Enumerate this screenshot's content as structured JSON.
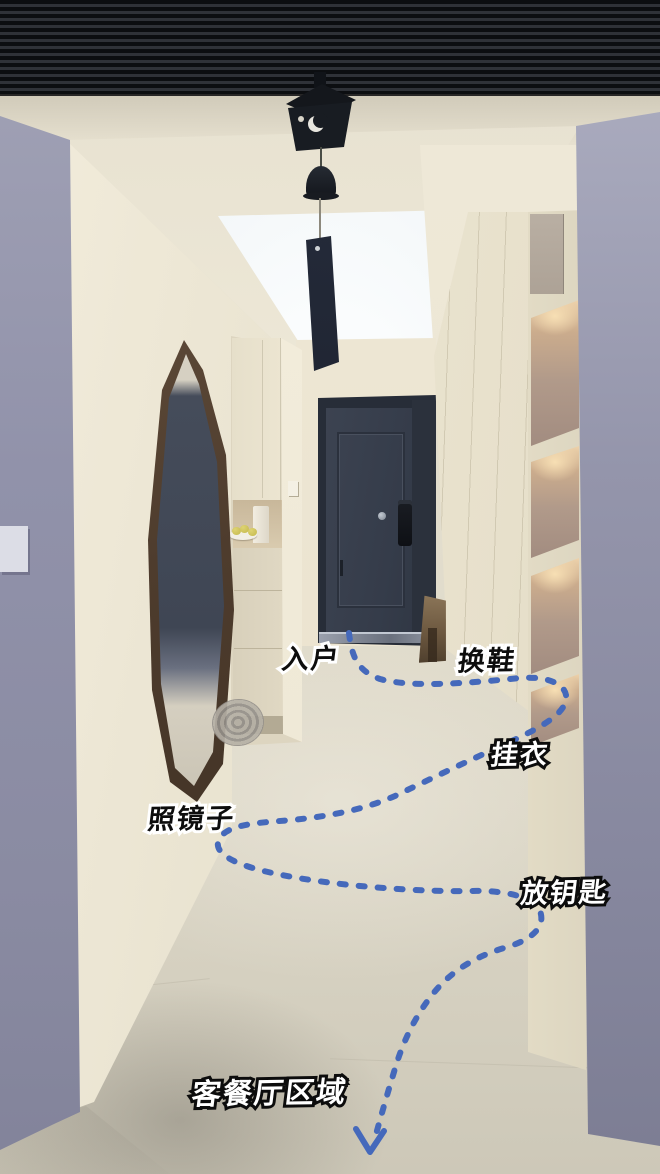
{
  "scene": {
    "type": "annotated-interior-photo",
    "description": "入户走廊动线示意",
    "route": {
      "color": "#4569bb",
      "style": "dashed",
      "direction": "entry-door to living-dining area"
    },
    "annotations": {
      "entry": "入户",
      "change_shoes": "换鞋",
      "hang_clothes": "挂衣",
      "look_in_mirror": "照镜子",
      "place_keys": "放钥匙",
      "living_dining_area": "客餐厅区域"
    },
    "palette": {
      "ceiling_black": "#17191d",
      "wall_cream": "#ebe4d1",
      "foreground_wall_gray": "#8f90a8",
      "door_navy": "#373e4c",
      "mirror_wood": "#4e3c2d",
      "floor_greige": "#d9d4c4",
      "shelf_glow": "#edd2ab"
    }
  }
}
